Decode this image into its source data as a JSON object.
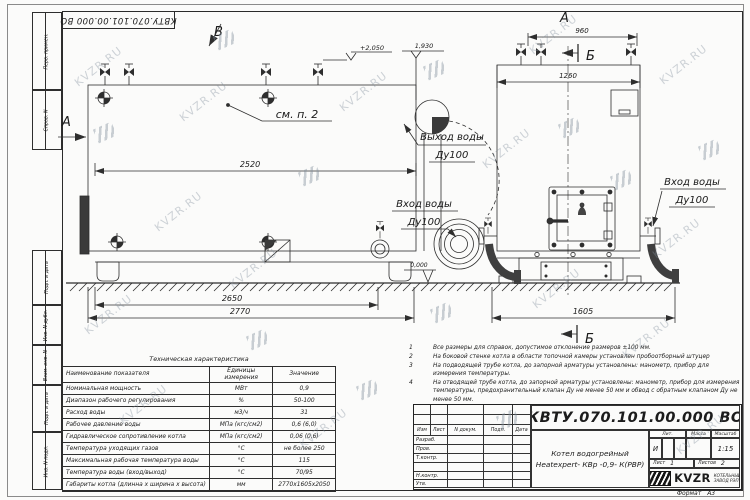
{
  "watermark": {
    "text": "KVZR.RU"
  },
  "frame": {
    "stamp_designation": "КВТУ.070.101.00.000  ВО",
    "left_labels": [
      "Перв. примен.",
      "Справ. N",
      "Подп. и дата",
      "Инв. N дубл.",
      "Взам. инв. N",
      "Подп. и дата",
      "Инв. N подл."
    ],
    "format_label": "Формат",
    "format_value": "А3"
  },
  "views": {
    "label_b_top": "В",
    "label_a_side": "А",
    "label_a_end": "А",
    "section_b_top": "Б",
    "section_b_bottom": "Б",
    "see_note": "см. п. 2",
    "dim_2520": "2520",
    "dim_2650": "2650",
    "dim_2770": "2770",
    "dim_960": "960",
    "dim_1260": "1260",
    "dim_1605": "1605",
    "elev_top": "+2,050",
    "elev_flue": "1,930",
    "elev_ground": "0,000",
    "callout_out_l1": "Выход воды",
    "callout_out_l2": "Ду100",
    "callout_in_main_l1": "Вход воды",
    "callout_in_main_l2": "Ду100",
    "callout_in_end_l1": "Вход воды",
    "callout_in_end_l2": "Ду100"
  },
  "spec_table": {
    "title": "Техническая характеристика",
    "headers": [
      "Наименование показателя",
      "Единицы измерения",
      "Значение"
    ],
    "rows": [
      [
        "Номинальная мощность",
        "МВт",
        "0,9"
      ],
      [
        "Диапазон рабочего регулирования",
        "%",
        "50-100"
      ],
      [
        "Расход воды",
        "м3/ч",
        "31"
      ],
      [
        "Рабочее давление воды",
        "МПа (кгс/см2)",
        "0,6 (6,0)"
      ],
      [
        "Гидравлическое сопротивление котла",
        "МПа (кгс/см2)",
        "0,06 (0,6)"
      ],
      [
        "Температура уходящих газов",
        "°С",
        "не более 250"
      ],
      [
        "Максимальная рабочая температура воды",
        "°С",
        "115"
      ],
      [
        "Температура воды (вход/выход)",
        "°С",
        "70/95"
      ],
      [
        "Габариты котла (длинна х ширина х высота)",
        "мм",
        "2770х1605х2050"
      ]
    ]
  },
  "notes": [
    {
      "num": "1",
      "text": "Все размеры для справок, допустимое отклонение размеров ±100 мм."
    },
    {
      "num": "2",
      "text": "На боковой стенке котла в области топочной камеры установлен пробоотборный штуцер"
    },
    {
      "num": "3",
      "text": "На подводящей трубе котла, до запорной арматуры установлены: манометр, прибор для измерения температуры."
    },
    {
      "num": "4",
      "text": "На отводящей трубе котла, до запорной арматуры установлены: манометр, прибор для измерения температуры, предохранительный клапан Ду не менее 50 мм и обвод с обратным клапаном Ду не менее 50 мм."
    }
  ],
  "title_block": {
    "designation": "КВТУ.070.101.00.000  ВО",
    "product_line1": "Котел водогрейный",
    "product_line2": "Heatexpert- КВр -0,9- К(РВР)",
    "rev_headers": [
      "Изм",
      "Лист",
      "N докум.",
      "Подп.",
      "Дата"
    ],
    "roles": [
      "Разраб.",
      "Пров.",
      "Т.контр.",
      "Н.контр.",
      "Утв."
    ],
    "lit_label": "Лит.",
    "lit_value": "И",
    "mass_label": "Масса",
    "scale_label": "Масштаб",
    "scale_value": "1:15",
    "sheet_label": "Лист",
    "sheet_value": "1",
    "sheets_label": "Листов",
    "sheets_value": "2",
    "logo_text": "KVZR",
    "company_line1": "КОТЕЛЬНЫЙ",
    "company_line2": "ЗАВОД РЭП"
  }
}
